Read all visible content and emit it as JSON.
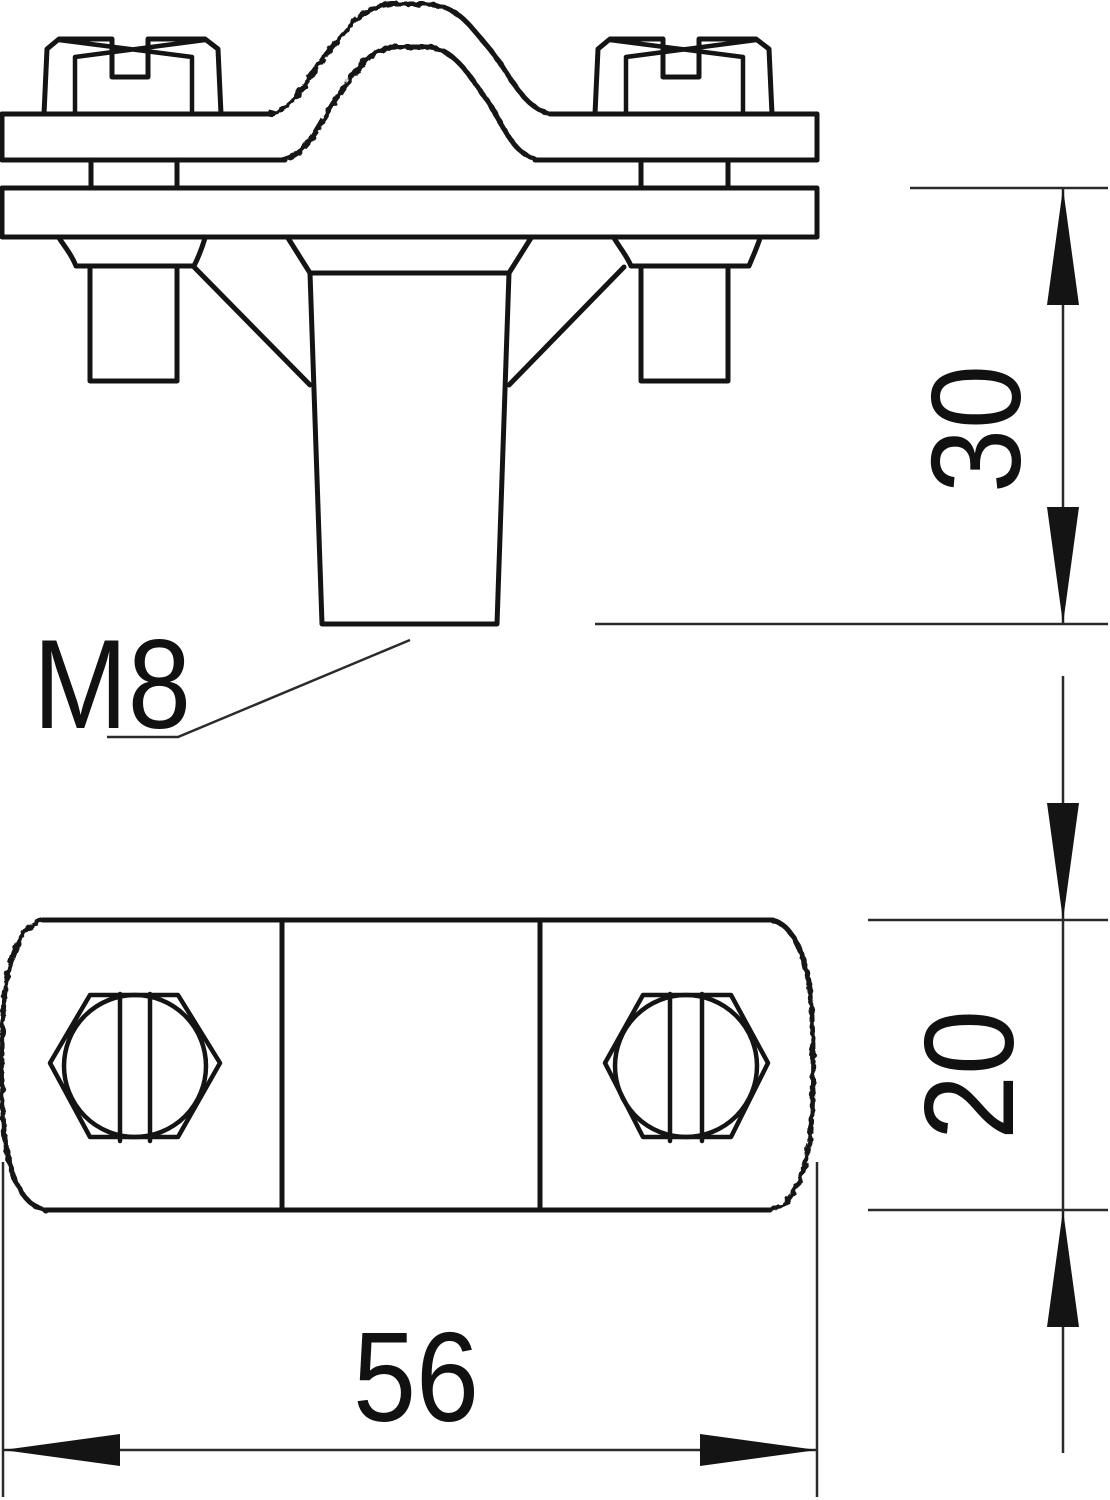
{
  "drawing": {
    "type": "technical-drawing-two-views",
    "thread_label": "M8",
    "dim_stud_height": "30",
    "dim_body_thickness": "20",
    "dim_body_width": "56",
    "views": {
      "front": "elevation with saddle clamp, two slotted screws and tapered M8 stud",
      "plan": "bottom body with knurled sides and two slotted hex screw heads"
    },
    "colors": {
      "line": "#141414",
      "thin_line": "#2b2b2b",
      "background": "#ffffff"
    }
  }
}
